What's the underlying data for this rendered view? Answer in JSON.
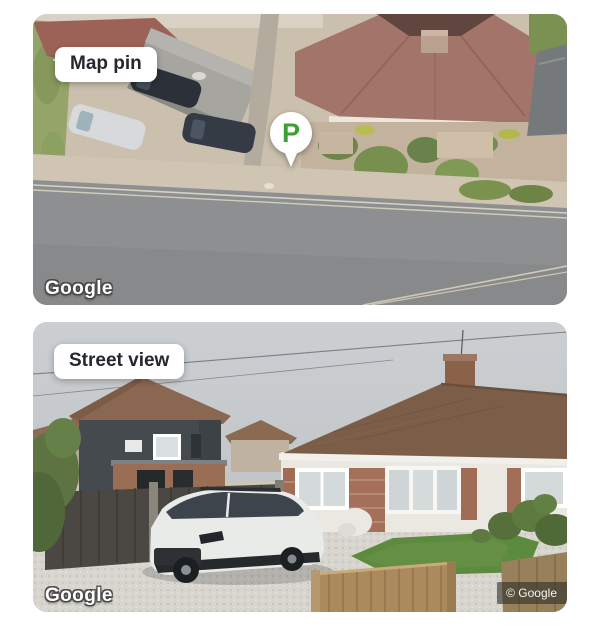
{
  "page": {
    "background_color": "#ffffff"
  },
  "panels": {
    "map_pin": {
      "label": "Map pin",
      "watermark": "Google",
      "pin": {
        "letter": "P",
        "color": "#3BA135",
        "bubble_color": "#ffffff"
      },
      "image_type": "aerial-satellite-view"
    },
    "street_view": {
      "label": "Street view",
      "watermark": "Google",
      "copyright": "© Google",
      "image_type": "street-level-photo"
    }
  }
}
